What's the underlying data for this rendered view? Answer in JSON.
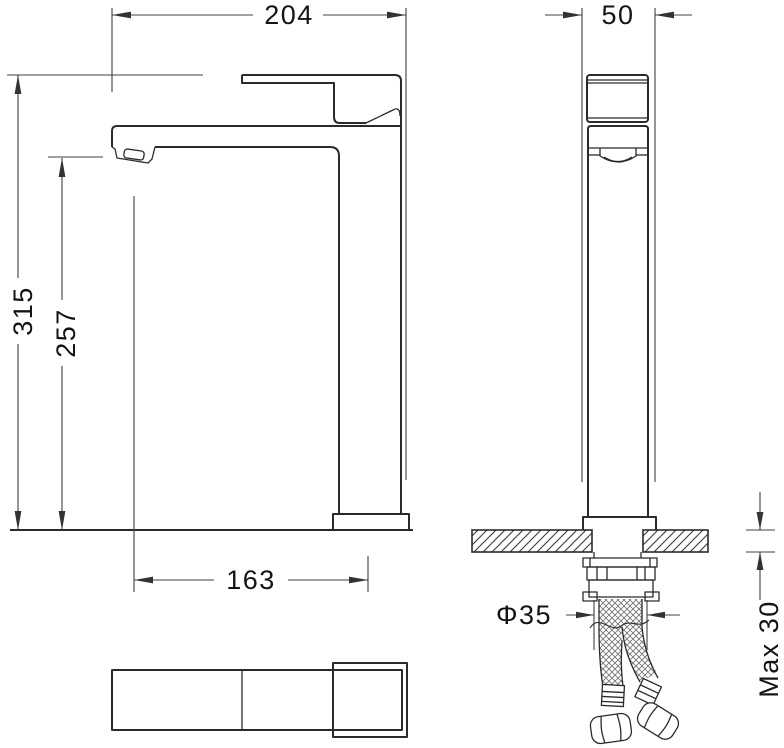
{
  "drawing": {
    "colors": {
      "line": "#2b2b2b",
      "dimension": "#404040",
      "background": "#ffffff"
    },
    "dimensions": {
      "front_width": "204",
      "side_width": "50",
      "overall_height": "315",
      "spout_height": "257",
      "base_to_spout_center": "163",
      "hole_diameter": "Φ35",
      "max_counter_thickness": "Max 30"
    }
  }
}
